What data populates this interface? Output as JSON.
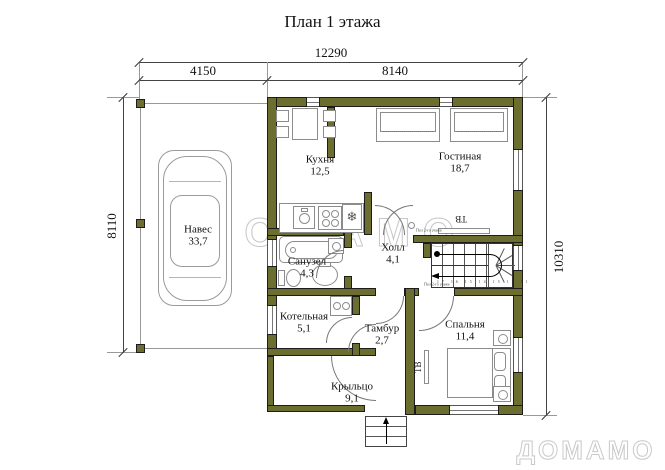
{
  "title": "План 1 этажа",
  "dimensions": {
    "total": "12290",
    "canopy": "4150",
    "house": "8140",
    "left": "8110",
    "right": "10310"
  },
  "rooms": {
    "kitchen": {
      "name": "Кухня",
      "area": "12,5"
    },
    "living": {
      "name": "Гостиная",
      "area": "18,7"
    },
    "canopy": {
      "name": "Навес",
      "area": "33,7"
    },
    "hall": {
      "name": "Холл",
      "area": "4,1"
    },
    "bathroom": {
      "name": "Санузел",
      "area": "4,3"
    },
    "boiler": {
      "name": "Котельная",
      "area": "5,1"
    },
    "vestibule": {
      "name": "Тамбур",
      "area": "2,7"
    },
    "bedroom": {
      "name": "Спальня",
      "area": "11,4"
    },
    "porch": {
      "name": "Крыльцо",
      "area": "9,1"
    }
  },
  "labels": {
    "tv_living": "ТВ",
    "tv_bedroom": "ТВ",
    "stair_note": "Пол 2-го этажа",
    "door_note": "Пол 2-го этажа",
    "tread_numbers": "17 16 15 14 13 12 11"
  },
  "icons": {
    "fridge": "❄"
  },
  "watermark": "ДОМАМО",
  "logo": "ДОМАМО",
  "colors": {
    "wall": "#6c6e2f",
    "outline": "#1c1c1c",
    "watermark": "#c6c6c6"
  }
}
